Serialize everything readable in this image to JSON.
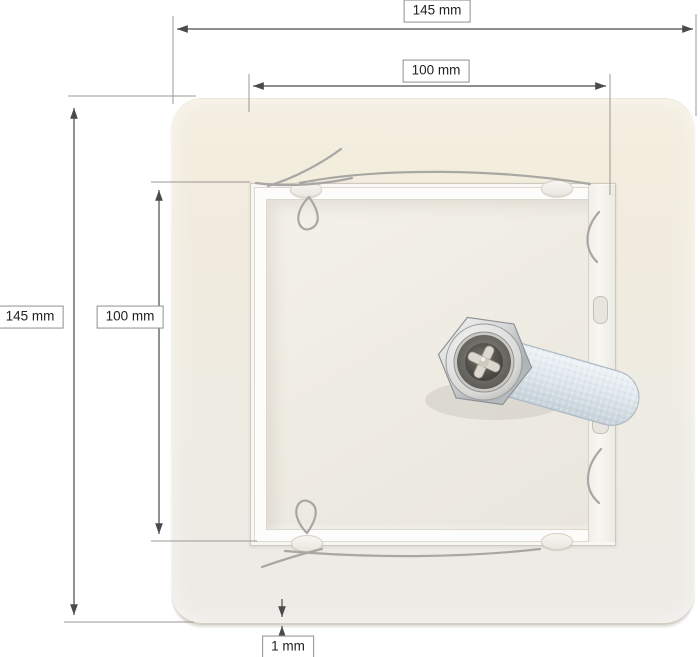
{
  "dimensions": {
    "outer_width": {
      "label": "145 mm"
    },
    "inner_width": {
      "label": "100 mm"
    },
    "outer_height": {
      "label": "145 mm"
    },
    "inner_height": {
      "label": "100 mm"
    },
    "edge_thickness": {
      "label": "1 mm"
    }
  },
  "colors": {
    "background": "#ffffff",
    "panel_cream": "#f3eee1",
    "panel_cool": "#edebe5",
    "frame_white": "#fcfcfb",
    "door_light": "#efece3",
    "lock_chrome": "#d9d9d9",
    "cam_zinc": "#d9e1e8",
    "dimension_line": "#4a4a4a",
    "extension_line": "#9b9893",
    "label_border": "#8f8f8f",
    "label_text": "#1f1f1f"
  }
}
